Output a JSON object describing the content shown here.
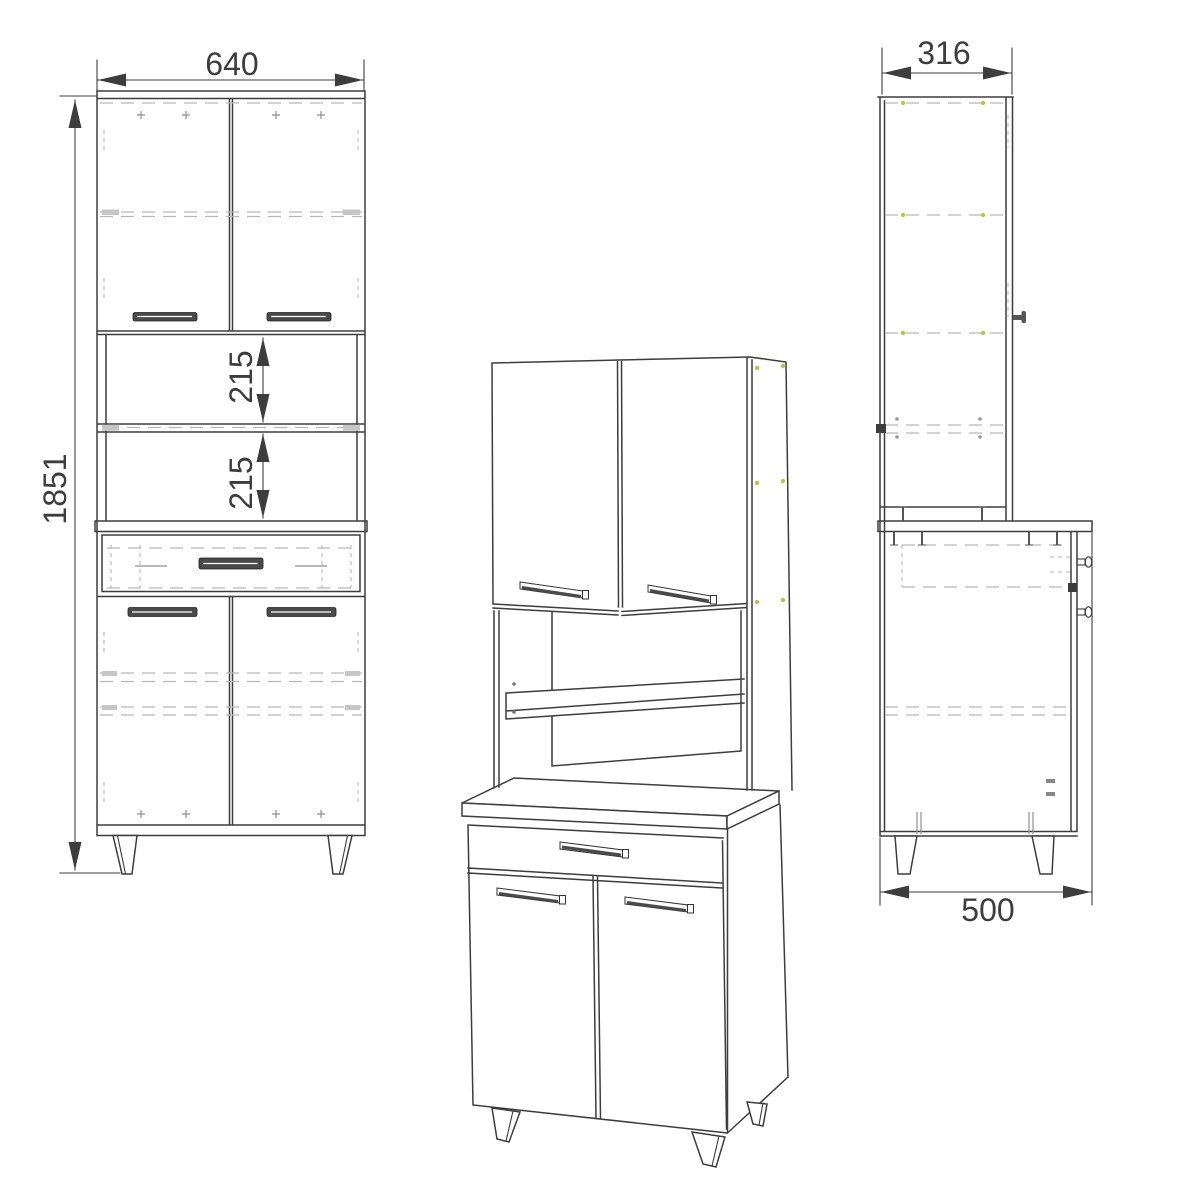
{
  "figure": {
    "type": "furniture-technical-drawing",
    "views": {
      "front": {
        "width_label": "640",
        "height_label": "1851",
        "upper_opening_label": "215",
        "lower_opening_label": "215"
      },
      "side": {
        "top_depth_label": "316",
        "base_depth_label": "500"
      }
    },
    "colors": {
      "line": "#3d3d3d",
      "dashed": "#b7b7b7",
      "fitting_dot": "#b9c445",
      "handle_fill": "#4a4a4a",
      "background": "#ffffff"
    }
  }
}
